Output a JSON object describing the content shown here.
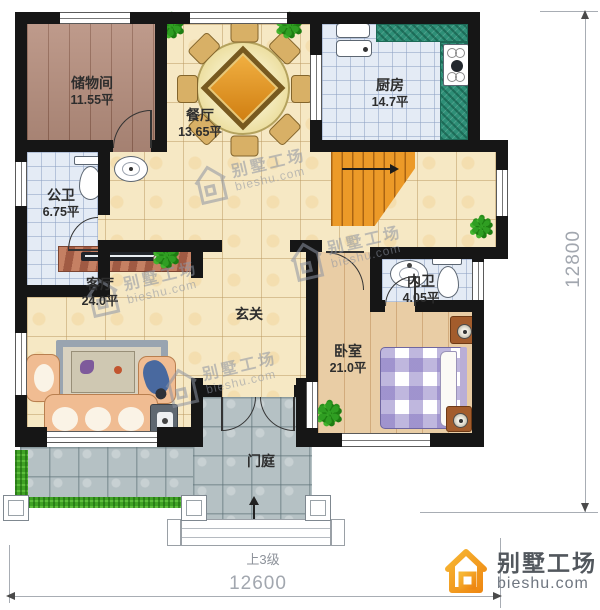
{
  "plan": {
    "rooms": [
      {
        "id": "storage",
        "name": "储物间",
        "area": "11.55平"
      },
      {
        "id": "dining",
        "name": "餐厅",
        "area": "13.65平"
      },
      {
        "id": "kitchen",
        "name": "厨房",
        "area": "14.7平"
      },
      {
        "id": "public-bath",
        "name": "公卫",
        "area": "6.75平"
      },
      {
        "id": "living",
        "name": "客厅",
        "area": "24.0平"
      },
      {
        "id": "hall",
        "name": "玄关",
        "area": ""
      },
      {
        "id": "inner-bath",
        "name": "内卫",
        "area": "4.05平"
      },
      {
        "id": "bedroom",
        "name": "卧室",
        "area": "21.0平"
      },
      {
        "id": "porch",
        "name": "门庭",
        "area": ""
      }
    ],
    "dimensions": {
      "width": "12600",
      "height": "12800"
    },
    "stairs_note": "上3级"
  },
  "watermark": {
    "brand": "别墅工场",
    "site": "bieshu.com"
  },
  "logo": {
    "brand": "别墅工场",
    "site": "bieshu.com"
  },
  "icons": {
    "plant": "✽"
  },
  "colors": {
    "wall": "#161616",
    "floor_cream": "#f6e8c4",
    "floor_wood": "#b78f7e",
    "floor_wood_light": "#e9cda5",
    "floor_tile": "#e4ebf5",
    "counter_green": "#2e8f77",
    "stairs_orange": "#ec9a28",
    "stone": "#b5c1c4",
    "grass": "#3fa224",
    "logo_orange": "#f0931f",
    "dim_gray": "#a2a7af"
  }
}
